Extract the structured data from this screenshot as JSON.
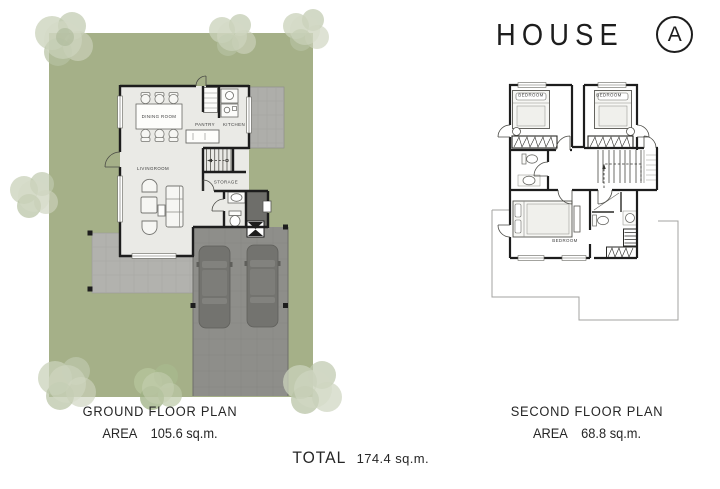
{
  "title": {
    "text": "HOUSE",
    "variant": "A"
  },
  "plans": {
    "ground": {
      "caption": "GROUND FLOOR PLAN",
      "area_label": "AREA",
      "area_value": "105.6 sq.m.",
      "rooms": {
        "dining": "DINING ROOM",
        "pantry": "PANTRY",
        "kitchen": "KITCHEN",
        "living": "LIVINGROOM",
        "storage": "STORAGE"
      }
    },
    "second": {
      "caption": "SECOND FLOOR PLAN",
      "area_label": "AREA",
      "area_value": "68.8 sq.m.",
      "rooms": {
        "bedroom_left": "BEDROOM",
        "bedroom_right": "BEDROOM",
        "bedroom_master": "BEDROOM"
      }
    }
  },
  "total": {
    "label": "TOTAL",
    "value": "174.4 sq.m."
  },
  "colors": {
    "lawn": "#a5b088",
    "floor": "#eaeae6",
    "terrace": "#b2b2ae",
    "deck": "#aeaeaa",
    "carport": "#8e8e8a",
    "car": "#73736f",
    "carroof": "#7d7d79",
    "entry": "#6e6e6a",
    "wall": "#1d1d1d",
    "ink": "#2e2e2e"
  }
}
